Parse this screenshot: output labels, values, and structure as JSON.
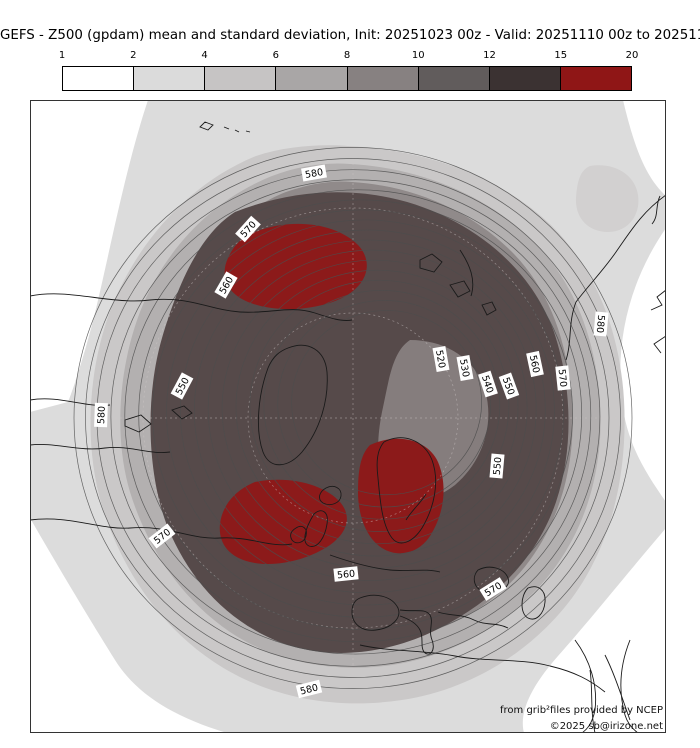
{
  "title": "GEFS - Z500 (gpdam) mean and standard deviation, Init: 20251023 00z - Valid: 20251110 00z to 20251117 00z",
  "colorbar": {
    "tick_labels": [
      "1",
      "2",
      "4",
      "6",
      "8",
      "10",
      "12",
      "15",
      "20"
    ],
    "segment_colors": [
      "#ffffff",
      "#dbdbdb",
      "#c6c4c4",
      "#a9a6a6",
      "#878181",
      "#615c5c",
      "#3b3232",
      "#8f1616"
    ]
  },
  "map": {
    "attribution_line1": "from grib²files provided by NCEP",
    "attribution_line2": "©2025 sb@irizone.net",
    "contour_labels": [
      {
        "text": "580",
        "x": 284,
        "y": 73,
        "rot": -10
      },
      {
        "text": "570",
        "x": 218,
        "y": 129,
        "rot": -48
      },
      {
        "text": "560",
        "x": 196,
        "y": 185,
        "rot": -60
      },
      {
        "text": "550",
        "x": 152,
        "y": 286,
        "rot": -62
      },
      {
        "text": "580",
        "x": 71,
        "y": 315,
        "rot": -88
      },
      {
        "text": "570",
        "x": 132,
        "y": 436,
        "rot": -38
      },
      {
        "text": "520",
        "x": 411,
        "y": 259,
        "rot": 80
      },
      {
        "text": "530",
        "x": 435,
        "y": 268,
        "rot": 80
      },
      {
        "text": "540",
        "x": 458,
        "y": 284,
        "rot": 72
      },
      {
        "text": "550",
        "x": 479,
        "y": 286,
        "rot": 70
      },
      {
        "text": "560",
        "x": 505,
        "y": 264,
        "rot": 78
      },
      {
        "text": "570",
        "x": 533,
        "y": 278,
        "rot": 84
      },
      {
        "text": "580",
        "x": 571,
        "y": 224,
        "rot": 95
      },
      {
        "text": "550",
        "x": 467,
        "y": 366,
        "rot": -85
      },
      {
        "text": "560",
        "x": 316,
        "y": 474,
        "rot": -6
      },
      {
        "text": "570",
        "x": 463,
        "y": 489,
        "rot": -32
      },
      {
        "text": "580",
        "x": 279,
        "y": 589,
        "rot": -14
      }
    ]
  },
  "chart_data": {
    "type": "heatmap",
    "title": "GEFS - Z500 (gpdam) mean and standard deviation, Init: 20251023 00z - Valid: 20251110 00z to 20251117 00z",
    "description": "Northern-hemisphere polar-stereographic map of GEFS ensemble-mean 500 hPa geopotential height (thin contour lines, gpdam) with ensemble standard deviation shaded (gpdam), discrete colorbar at top.",
    "contour_interval": 5,
    "labeled_contour_levels": [
      520,
      530,
      540,
      550,
      560,
      570,
      580
    ],
    "shading_bin_edges": [
      1,
      2,
      4,
      6,
      8,
      10,
      12,
      15,
      20
    ],
    "shading_bin_colors": [
      "#ffffff",
      "#dbdbdb",
      "#c6c4c4",
      "#a9a6a6",
      "#878181",
      "#615c5c",
      "#3b3232",
      "#8f1616"
    ],
    "std_dev_maxima_regions": [
      {
        "location_on_map": "upper-left quadrant (Siberian Arctic sector)",
        "std_dev_bin": "15-20"
      },
      {
        "location_on_map": "lower-left of center (North Atlantic, south of Iceland/west of UK)",
        "std_dev_bin": "15-20"
      },
      {
        "location_on_map": "lower-right of center (Scandinavia / Baltic sector)",
        "std_dev_bin": "15-20"
      }
    ],
    "mean_height_minimum": "closed 520 gpdam contour right of map center (Arctic low)",
    "mean_height_maximum": "580+ gpdam around the map periphery (mid-latitudes)",
    "legend_position": "top horizontal colorbar",
    "grid": "faint dashed lat/lon graticule"
  }
}
